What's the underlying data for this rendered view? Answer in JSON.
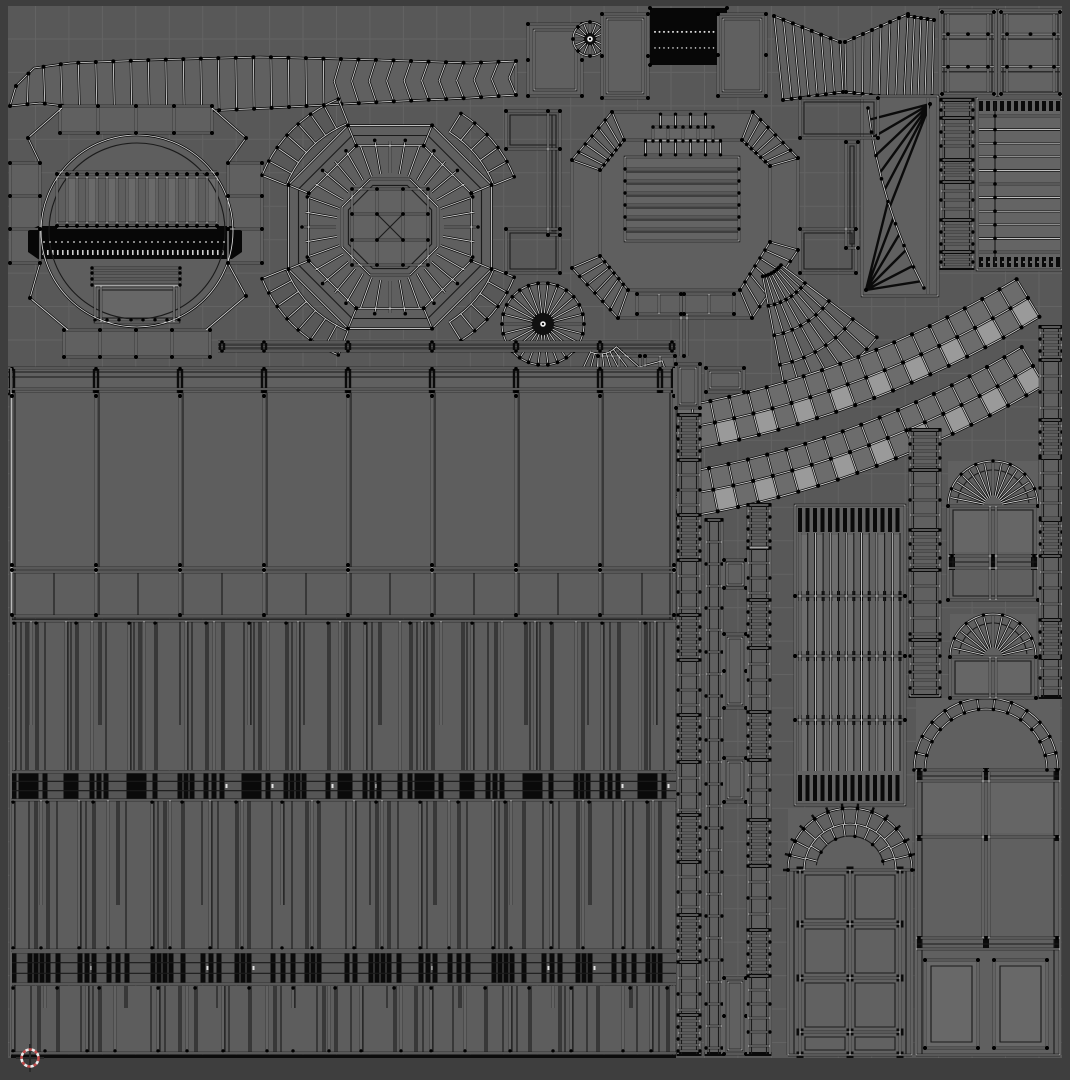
{
  "app": "uv-image-editor",
  "view": {
    "width": 1070,
    "height": 1080,
    "background": "#585858",
    "border_color": "#3e3e3e",
    "content_rect": [
      8,
      6,
      1054,
      1052
    ],
    "grid": {
      "color": "#636363",
      "spacing": 33.45,
      "offset_x": 2,
      "offset_y": 5.5
    }
  },
  "style": {
    "face": "#606060",
    "face_light": "#6a6a6a",
    "face_bright": "#9a9a9a",
    "edge_black": "#0b0b0b",
    "edge_core": "#d9d9d9",
    "edge_thin": "#1a1a1a",
    "vertex": "#000000",
    "white_dash": "#e2e2e2"
  },
  "cursor2d": {
    "x": 30,
    "y": 1058,
    "ring_red": "#c14b4b",
    "ring_white": "#ececec",
    "cross": "#2a2a2a"
  },
  "patterns": {
    "p1": [
      7,
      5,
      5,
      5,
      9,
      21,
      5,
      5,
      16,
      7,
      7,
      23,
      5,
      5,
      5,
      11,
      25,
      6,
      6,
      14,
      8,
      8,
      22,
      5,
      5,
      5,
      9,
      18,
      6,
      6,
      6,
      24,
      12,
      5,
      5,
      15,
      7,
      7,
      21,
      10
    ],
    "p2": [
      16,
      6,
      6,
      6,
      10,
      22,
      7,
      7,
      15,
      9,
      9,
      26,
      6,
      6,
      6,
      12,
      20,
      8,
      8,
      18,
      6,
      6,
      24,
      10,
      10,
      14,
      6,
      6,
      28,
      8
    ],
    "p3": [
      18,
      7,
      7,
      12,
      24,
      6,
      6,
      6,
      16,
      10,
      26,
      7,
      7,
      14,
      8,
      8,
      22,
      6,
      6,
      20
    ]
  },
  "islands": [
    {
      "id": "top-arch-band",
      "type": "band",
      "top": [
        [
          16,
          86
        ],
        [
          34,
          68
        ],
        [
          70,
          63
        ],
        [
          150,
          60
        ],
        [
          260,
          57
        ],
        [
          380,
          60
        ],
        [
          470,
          63
        ],
        [
          516,
          61
        ]
      ],
      "bot": [
        [
          10,
          106
        ],
        [
          40,
          103
        ],
        [
          80,
          108
        ],
        [
          160,
          113
        ],
        [
          270,
          108
        ],
        [
          380,
          102
        ],
        [
          470,
          98
        ],
        [
          516,
          95
        ]
      ],
      "ribs": 30,
      "chev": 0.63
    },
    {
      "id": "top-band-cap",
      "type": "frame",
      "x": 528,
      "y": 24,
      "w": 54,
      "h": 72,
      "ins": [
        0,
        6
      ]
    },
    {
      "id": "small-fan-disc",
      "type": "disc",
      "cx": 590,
      "cy": 39,
      "r": 17,
      "n": 16,
      "dark": 4
    },
    {
      "id": "frame-a",
      "type": "frame",
      "x": 602,
      "y": 14,
      "w": 46,
      "h": 84,
      "ins": [
        0,
        5
      ]
    },
    {
      "id": "vertex-block",
      "type": "black",
      "x": 650,
      "y": 8,
      "w": 77,
      "h": 57,
      "rows": [
        0.42,
        0.7
      ]
    },
    {
      "id": "frame-b",
      "type": "frame",
      "x": 718,
      "y": 14,
      "w": 48,
      "h": 82,
      "ins": [
        0,
        5
      ]
    },
    {
      "id": "bowtie-left-wing",
      "type": "wing",
      "ta": [
        774,
        16
      ],
      "tb": [
        840,
        42
      ],
      "ba": [
        783,
        100
      ],
      "bb": [
        843,
        92
      ],
      "n": 7
    },
    {
      "id": "bowtie-right-wing",
      "type": "wing",
      "ta": [
        845,
        42
      ],
      "tb": [
        908,
        14
      ],
      "ba": [
        846,
        92
      ],
      "bb": [
        904,
        99
      ],
      "n": 7
    },
    {
      "id": "bowtie-edge-wing",
      "type": "wing",
      "ta": [
        908,
        16
      ],
      "tb": [
        934,
        20
      ],
      "ba": [
        904,
        99
      ],
      "bb": [
        932,
        96
      ],
      "n": 4
    },
    {
      "id": "panel-top-right-1",
      "type": "panel7",
      "x": 940,
      "y": 10,
      "w": 56,
      "h": 86
    },
    {
      "id": "panel-top-right-2",
      "type": "panel7",
      "x": 999,
      "y": 10,
      "w": 63,
      "h": 86
    },
    {
      "id": "ribbed-panel-right",
      "type": "hpanel",
      "x": 977,
      "y": 98,
      "w": 85,
      "h": 172,
      "ribs": 11
    },
    {
      "id": "strip-right-top",
      "type": "ladder",
      "x": 941,
      "w": 32,
      "segs": [
        [
          100,
          112,
          5
        ],
        [
          118,
          152,
          7
        ],
        [
          160,
          176,
          5
        ],
        [
          182,
          214,
          9
        ],
        [
          220,
          248,
          6
        ],
        [
          252,
          268,
          5
        ]
      ]
    },
    {
      "id": "sail-island",
      "type": "kite",
      "x": 862,
      "y": 96,
      "w": 76,
      "h": 200
    },
    {
      "id": "octagon-room-left",
      "type": "octoleft"
    },
    {
      "id": "rose-ring",
      "type": "rose",
      "cx": 390,
      "cy": 227
    },
    {
      "id": "mid-fan-disc",
      "type": "disc",
      "cx": 543,
      "cy": 324,
      "r": 41,
      "n": 26,
      "dark": 9,
      "rim": 1
    },
    {
      "id": "thin-rail",
      "type": "rail",
      "x0": 218,
      "x1": 676,
      "y": 342
    },
    {
      "id": "octagon-room-center",
      "type": "octocenter"
    },
    {
      "id": "curved-sheet",
      "type": "sheet",
      "cx": 757,
      "cy": 247,
      "r0": 30,
      "r1": 150,
      "a0": 281,
      "a1": 323,
      "rows": 4,
      "cols": 7
    },
    {
      "id": "brick-arc-upper",
      "type": "brick",
      "p0": [
        676,
        430
      ],
      "c1": [
        862,
        398
      ],
      "p1": [
        1028,
        298
      ],
      "w": 44,
      "cols": 19
    },
    {
      "id": "brick-arc-lower",
      "type": "brick",
      "p0": [
        673,
        497
      ],
      "c1": [
        866,
        466
      ],
      "p1": [
        1033,
        366
      ],
      "w": 44,
      "cols": 19
    },
    {
      "id": "cornice-band",
      "type": "cornice",
      "x0": 8,
      "x1": 676,
      "y": 367
    },
    {
      "id": "wall-panels",
      "type": "walls"
    },
    {
      "id": "mullion-band",
      "type": "mull",
      "x0": 14,
      "x1": 672,
      "y0": 621,
      "y1": 770,
      "gaps": "p1",
      "top": 1
    },
    {
      "id": "knot-row-1",
      "type": "knots",
      "x0": 12,
      "x1": 676,
      "y": 772,
      "h": 28,
      "gaps": "p1"
    },
    {
      "id": "wall-band-2",
      "type": "mull",
      "x0": 13,
      "x1": 672,
      "y0": 800,
      "y1": 950,
      "gaps": "p2",
      "top": 1,
      "bot": 1
    },
    {
      "id": "knot-row-2",
      "type": "knots",
      "x0": 12,
      "x1": 676,
      "y": 952,
      "h": 32,
      "gaps": "p2"
    },
    {
      "id": "wall-band-3",
      "type": "mull",
      "x0": 13,
      "x1": 672,
      "y0": 986,
      "y1": 1053,
      "gaps": "p3",
      "bot": 2
    },
    {
      "id": "tab-frame-1",
      "type": "frame",
      "x": 676,
      "y": 364,
      "w": 24,
      "h": 44,
      "ins": [
        0,
        4
      ]
    },
    {
      "id": "tab-frame-2",
      "type": "frame",
      "x": 706,
      "y": 368,
      "w": 38,
      "h": 24,
      "ins": [
        0,
        4
      ]
    },
    {
      "id": "column-strip-a",
      "type": "ladder",
      "x": 678,
      "w": 22,
      "segs": [
        [
          415,
          460,
          6
        ],
        [
          460,
          515,
          15
        ],
        [
          515,
          560,
          6
        ],
        [
          560,
          615,
          16
        ],
        [
          615,
          660,
          6
        ],
        [
          660,
          715,
          15
        ],
        [
          715,
          762,
          6
        ],
        [
          762,
          815,
          16
        ],
        [
          815,
          862,
          6
        ],
        [
          862,
          915,
          15
        ],
        [
          915,
          962,
          6
        ],
        [
          962,
          1015,
          16
        ],
        [
          1015,
          1054,
          6
        ]
      ]
    },
    {
      "id": "column-strip-c",
      "type": "ladder",
      "x": 706,
      "w": 16,
      "segs": [
        [
          520,
          1054,
          22
        ]
      ]
    },
    {
      "id": "tab-3",
      "type": "frame",
      "x": 724,
      "y": 560,
      "w": 22,
      "h": 28,
      "ins": [
        0,
        3
      ]
    },
    {
      "id": "tab-4",
      "type": "frame",
      "x": 724,
      "y": 634,
      "w": 22,
      "h": 74,
      "ins": [
        0,
        4
      ]
    },
    {
      "id": "tab-5",
      "type": "frame",
      "x": 724,
      "y": 758,
      "w": 22,
      "h": 44,
      "ins": [
        0,
        4
      ]
    },
    {
      "id": "tab-6",
      "type": "frame",
      "x": 724,
      "y": 978,
      "w": 22,
      "h": 76,
      "ins": [
        0,
        4
      ]
    },
    {
      "id": "column-strip-b",
      "type": "ladder",
      "x": 748,
      "w": 22,
      "segs": [
        [
          505,
          548,
          6
        ],
        [
          548,
          600,
          15
        ],
        [
          600,
          648,
          6
        ],
        [
          648,
          712,
          16
        ],
        [
          712,
          760,
          6
        ],
        [
          760,
          820,
          15
        ],
        [
          820,
          866,
          6
        ],
        [
          866,
          930,
          16
        ],
        [
          930,
          976,
          6
        ],
        [
          976,
          1054,
          14
        ]
      ]
    },
    {
      "id": "mullion-panel",
      "type": "lpanel",
      "x": 795,
      "y": 505,
      "w": 110,
      "h": 300
    },
    {
      "id": "arched-door",
      "type": "door",
      "cx": 850,
      "sy": 870,
      "y1": 1055
    },
    {
      "id": "arched-window-large",
      "type": "bigwin",
      "x0": 916,
      "x1": 1060,
      "cx": 986,
      "sy": 770,
      "y1": 1055
    },
    {
      "id": "fan-window-1",
      "type": "fanwin",
      "cx": 993,
      "sy": 506,
      "r": 45,
      "x0": 948,
      "x1": 1038,
      "y1": 600,
      "rail": 556,
      "n": 16
    },
    {
      "id": "fan-window-2",
      "type": "fanwin",
      "cx": 993,
      "sy": 657,
      "r": 43,
      "x0": 950,
      "x1": 1036,
      "y1": 698,
      "n": 14
    },
    {
      "id": "strip-right-1",
      "type": "ladder",
      "x": 1040,
      "w": 22,
      "segs": [
        [
          327,
          360,
          6
        ],
        [
          360,
          420,
          16
        ],
        [
          420,
          458,
          6
        ],
        [
          458,
          520,
          15
        ],
        [
          520,
          556,
          6
        ],
        [
          556,
          620,
          16
        ],
        [
          620,
          658,
          6
        ],
        [
          658,
          697,
          10
        ]
      ]
    },
    {
      "id": "strip-right-2",
      "type": "ladder",
      "x": 910,
      "w": 30,
      "segs": [
        [
          430,
          470,
          7
        ],
        [
          470,
          530,
          15
        ],
        [
          530,
          570,
          7
        ],
        [
          570,
          640,
          16
        ],
        [
          640,
          696,
          8
        ]
      ]
    }
  ]
}
